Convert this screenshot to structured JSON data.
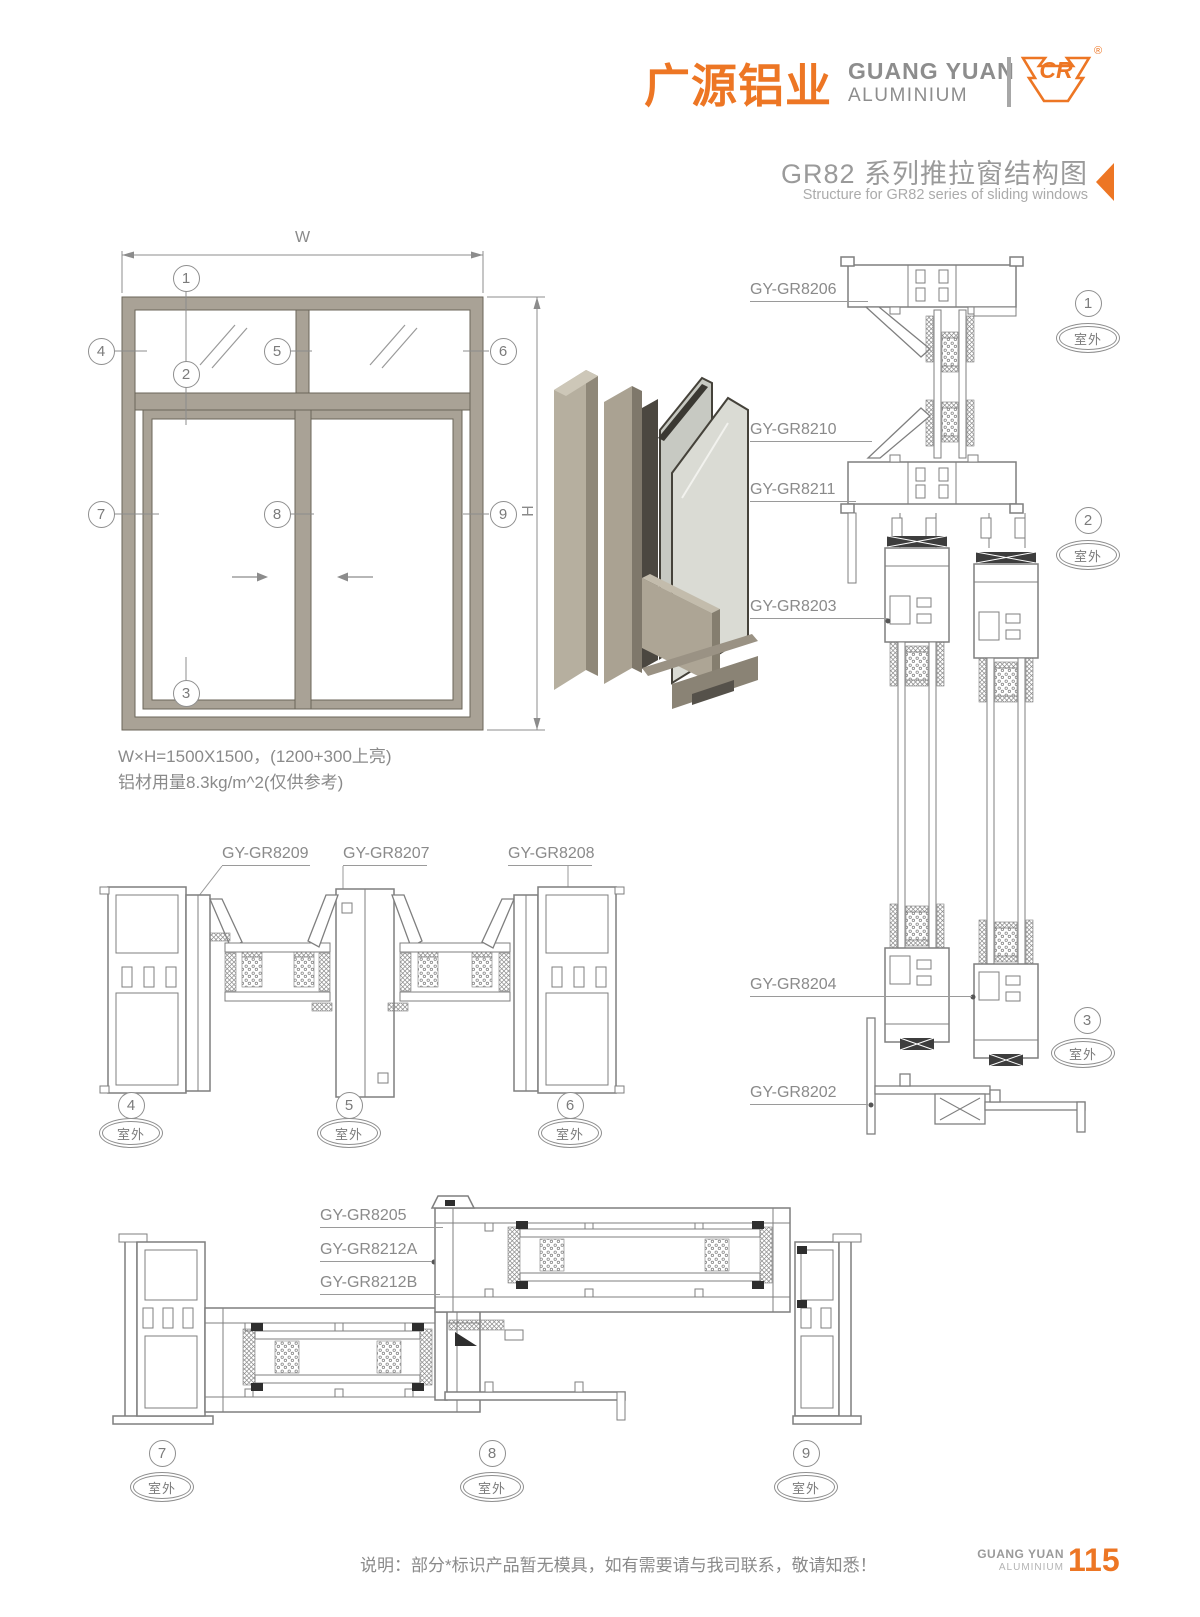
{
  "header": {
    "logo_cn": "广源铝业",
    "logo_en_line1": "GUANG YUAN",
    "logo_en_line2": "ALUMINIUM",
    "logo_mark": "CR",
    "registered_mark": "®",
    "title_cn": "GR82 系列推拉窗结构图",
    "title_en": "Structure for GR82 series of sliding windows"
  },
  "elevation": {
    "dim_w": "W",
    "dim_h": "H",
    "spec_line1": "W×H=1500X1500，(1200+300上亮)",
    "spec_line2": "铝材用量8.3kg/m^2(仅供参考)",
    "callouts": [
      "1",
      "2",
      "3",
      "4",
      "5",
      "6",
      "7",
      "8",
      "9"
    ]
  },
  "sections": {
    "outdoor_label": "室外",
    "vertical": {
      "labels": [
        "GY-GR8206",
        "GY-GR8210",
        "GY-GR8211",
        "GY-GR8203",
        "GY-GR8204",
        "GY-GR8202"
      ],
      "callouts": [
        "1",
        "2",
        "3"
      ]
    },
    "horizontal_mid": {
      "labels": [
        "GY-GR8209",
        "GY-GR8207",
        "GY-GR8208"
      ],
      "callouts": [
        "4",
        "5",
        "6"
      ]
    },
    "horizontal_bottom": {
      "labels": [
        "GY-GR8205",
        "GY-GR8212A",
        "GY-GR8212B"
      ],
      "callouts": [
        "7",
        "8",
        "9"
      ]
    }
  },
  "footer": {
    "note": "说明：部分*标识产品暂无模具，如有需要请与我司联系，敬请知悉！",
    "brand_line1": "GUANG YUAN",
    "brand_line2": "ALUMINIUM",
    "page_number": "115"
  },
  "colors": {
    "accent": "#ED7624",
    "text_gray": "#8D8D8D",
    "drawing_line": "#7F7F7F",
    "frame_tan": "#A9A296"
  }
}
